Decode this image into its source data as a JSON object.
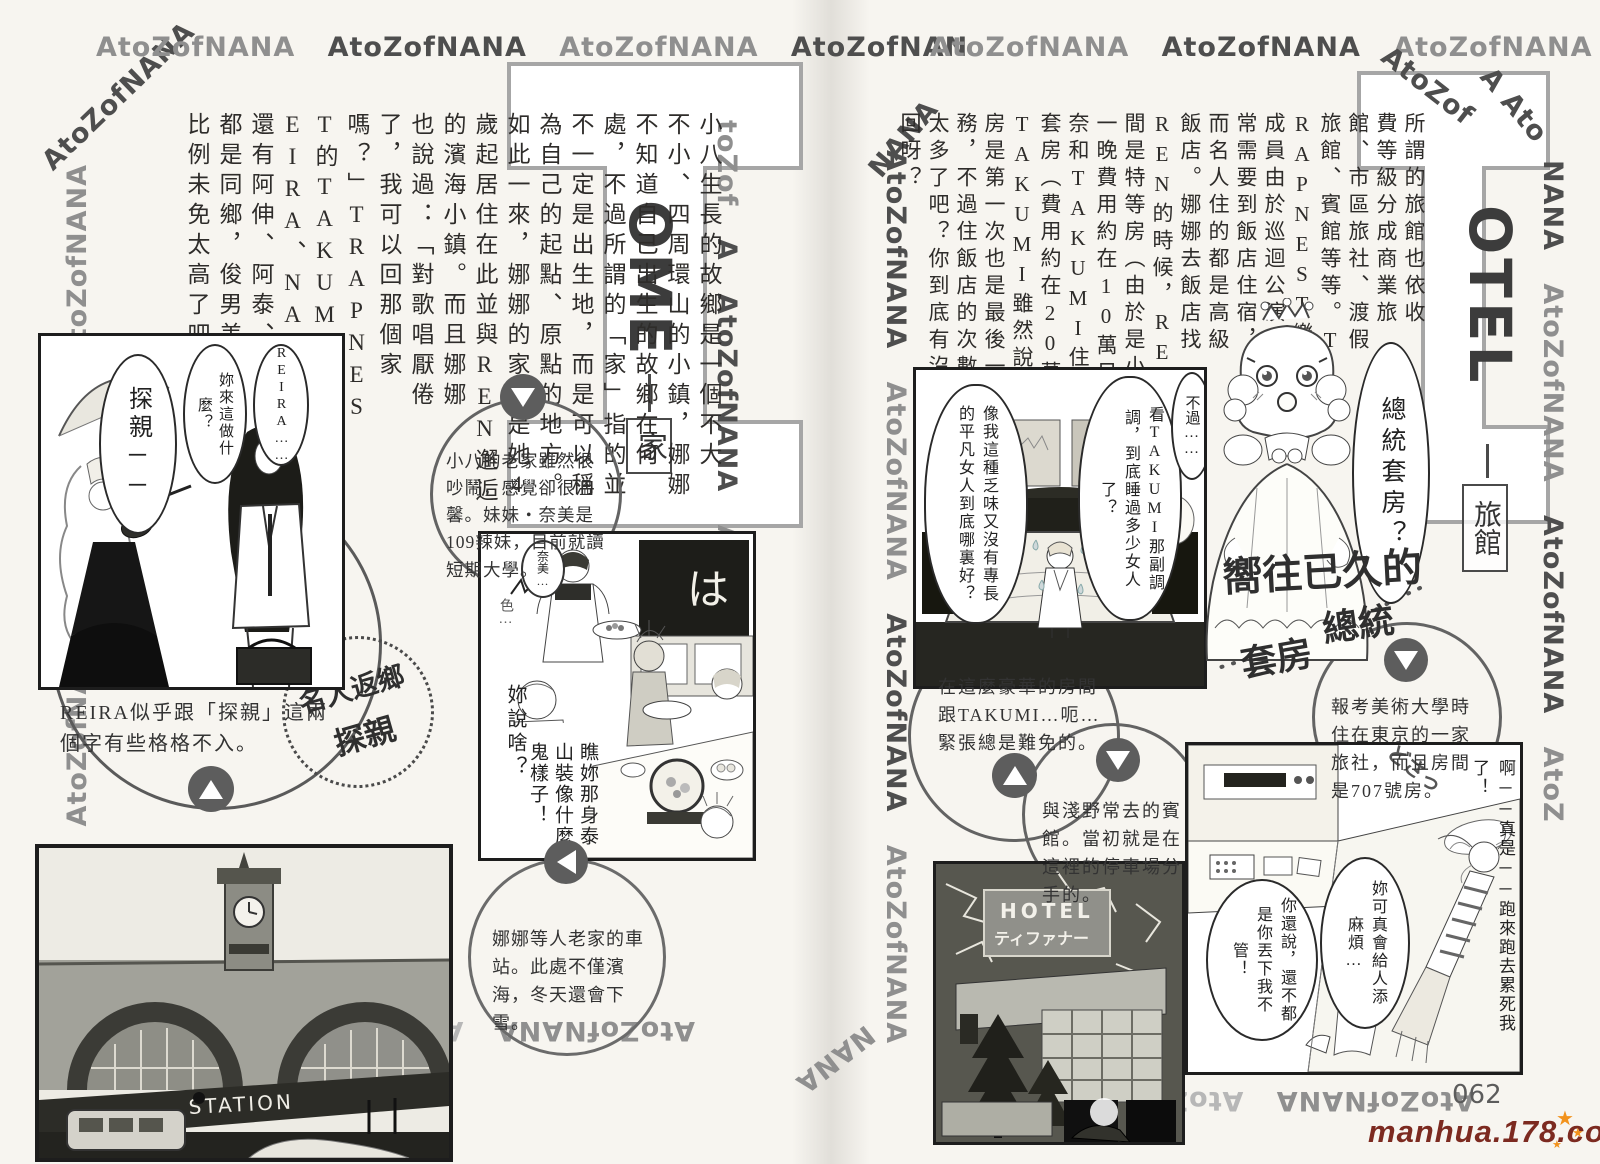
{
  "border_text": "AtoZofNANA",
  "fragments": {
    "nan": "AtoZofNAN",
    "tozof": "toZof",
    "fozofnana": "foZofNANA",
    "a": "A",
    "a_ato": "A Ato",
    "nana": "NANA",
    "atozof": "AtoZof",
    "atoz": "AtoZ"
  },
  "page": {
    "number": "062",
    "watermark": "manhua.178.com",
    "star": "★"
  },
  "left_page": {
    "title": {
      "big_letter": "H",
      "rest": "OME",
      "category": "家"
    },
    "body_columns": [
      "小八生長的故鄉是一個不大",
      "不小、四周環山的小鎮，娜娜",
      "不知道自己出生的故鄉在何",
      "處，不過所謂的「家」指的並",
      "不一定是出生地，而是可以稱",
      "為自己的起點、原點的地方。",
      "如此一來，娜娜的家就是她4",
      "歲起居住在此並與REN邂逅",
      "的濱海小鎮。而且娜娜",
      "也說過：「對歌唱厭倦",
      "了，我可以回那個家",
      "嗎？」TRAPNES",
      "T的TAKUMI、R",
      "EIRA、NAOKI",
      "還有阿伸、阿泰、美里",
      "都是同鄉，俊男美女的",
      "比例未免太高了吧？"
    ],
    "panel1": {
      "bubble_reira": "REIRA……",
      "bubble_what": "妳來這做什麼？",
      "bubble_visit": "探親──"
    },
    "caption_circle": "REIRA似乎跟「探親」這兩個字有些格格不入。",
    "stamp": {
      "line1": "名人返鄉",
      "line2": "探親"
    },
    "info_circle1": "小八的老家雖然很吵鬧，感覺卻很溫馨。妹妹・奈美是109辣妹，目前就讀短期大學。",
    "panel2": {
      "bubble_nami": "奈美…",
      "sfx_color": "色…",
      "bubble_what_say": "妳說啥？",
      "bubble_tarzan": "瞧妳那身泰山裝像什麼鬼樣子！",
      "tv_text": "は"
    },
    "station": {
      "sign": "STATION"
    },
    "info_circle2": "娜娜等人老家的車站。此處不僅濱海，冬天還會下雪。"
  },
  "right_page": {
    "title": {
      "big_letter": "H",
      "rest": "OTEL",
      "category": "旅館"
    },
    "body_columns": [
      "所謂的旅館也依收",
      "費等級分成商業旅",
      "館、市區旅社、渡假",
      "旅館、賓館等等。T",
      "RAPNEST樂團",
      "成員由於巡迴公演經",
      "常需要到飯店住宿，",
      "而名人住的都是高級",
      "飯店。娜娜去飯店找",
      "REN的時候，REN住的房",
      "間是特等房（由於是小城鎮，",
      "一晚費用約在10萬日圓），奈",
      "奈和TAKUMI住的是總統",
      "套房（費用約在20萬日圓）。",
      "TAKUMI雖然說住總統套",
      "房是第一次也是最後一次的服",
      "務，不過住飯店的次數未免也",
      "太多了吧？你到底有沒有家可",
      "回呀？"
    ],
    "bed_panel": {
      "bubble_however": "不過……",
      "bubble_takumi": "看TAKUMI那副調調，到底睡過多少女人了？",
      "bubble_plain": "像我這種乏味又沒有專長的平凡女人到底哪裏好？"
    },
    "princess_bubble": "總統套房？",
    "handwritten": {
      "line1": "嚮往已久的",
      "line2": "總統",
      "line3": "套房"
    },
    "info_circle_luxury": "在這麼豪華的房間跟TAKUMI…呃…緊張總是難免的。",
    "info_circle_asano": "與淺野常去的賓館。當初就是在這裡的停車場分手的。",
    "info_circle_707": "報考美術大學時住在東京的一家旅社，而且房間是707號房。",
    "hotel_sign": {
      "line1": "HOTEL",
      "line2": "ティファナー"
    },
    "room_panel": {
      "caption": "啊──真是──跑來跑去累死我了！",
      "sfx": "どさっ",
      "bubble_trouble": "妳可真會給人添麻煩…",
      "bubble_blame": "你還說，還不都是你丟下我不管！"
    }
  }
}
